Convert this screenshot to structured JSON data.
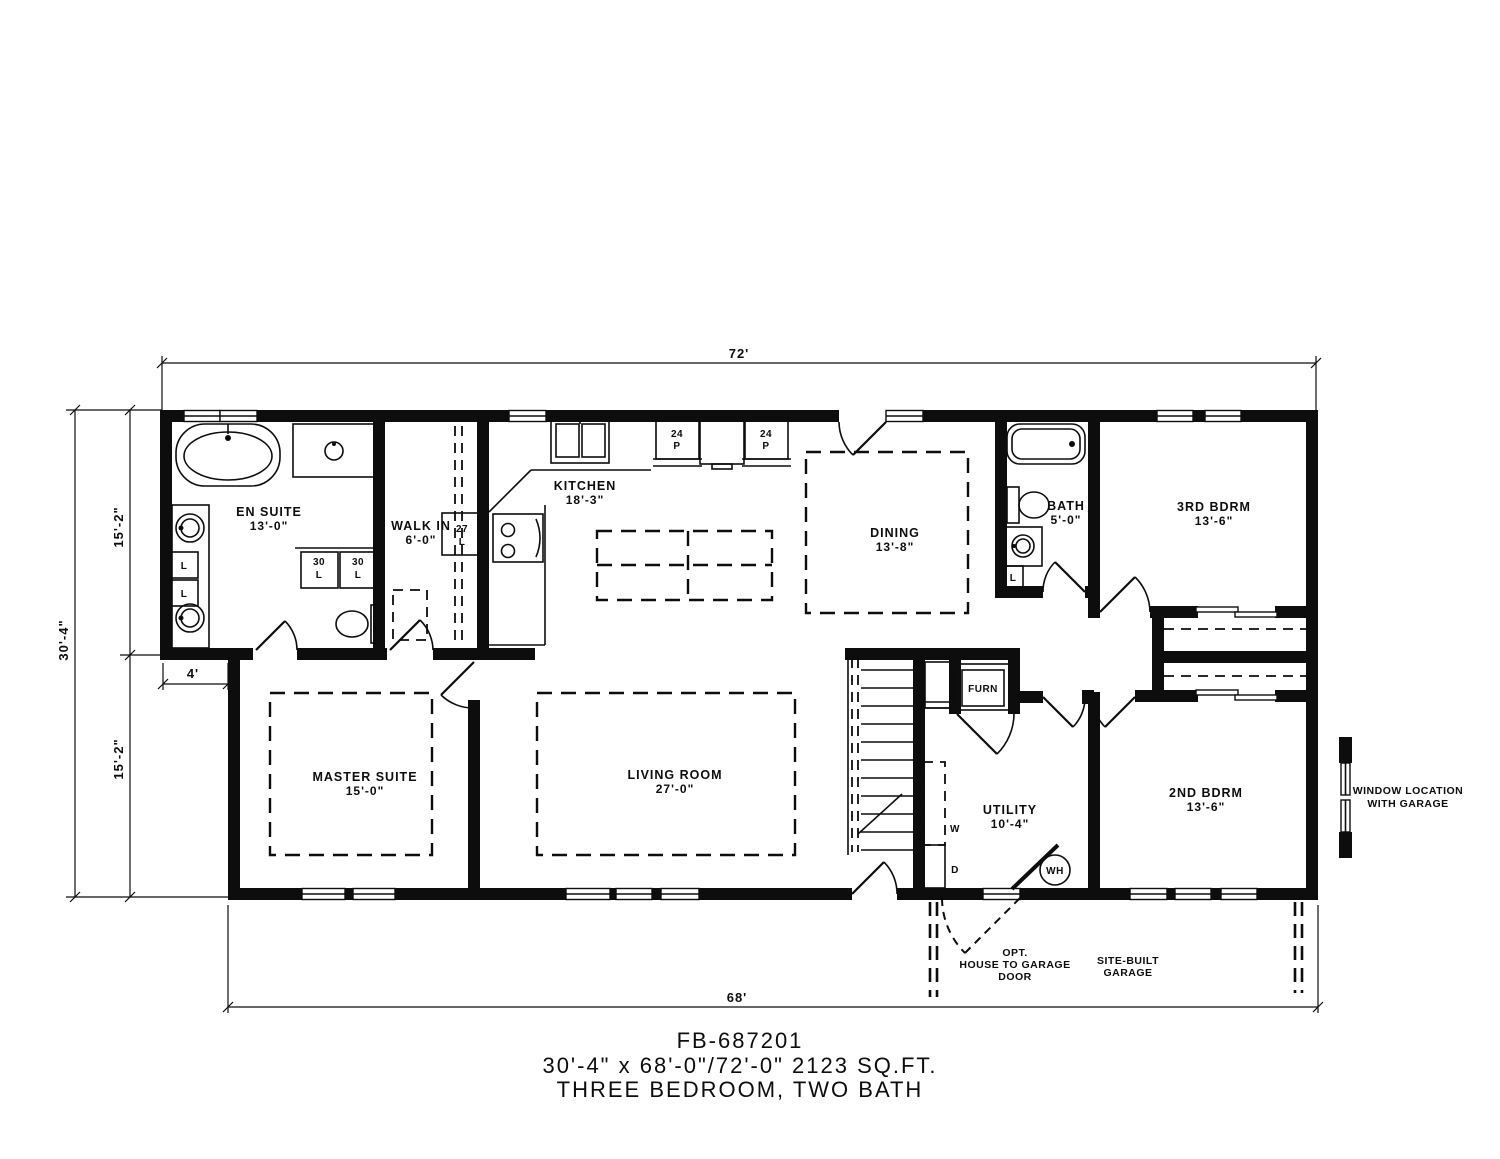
{
  "title": {
    "model": "FB-687201",
    "size_line": "30'-4\" x 68'-0\"/72'-0\" 2123 SQ.FT.",
    "beds_line": "THREE BEDROOM, TWO BATH"
  },
  "dimensions": {
    "top_width": "72'",
    "bottom_width": "68'",
    "left_total": "30'-4\"",
    "left_upper": "15'-2\"",
    "left_lower": "15'-2\"",
    "ensuite_offset": "4'"
  },
  "rooms": [
    {
      "label": "EN SUITE",
      "size": "13'-0\""
    },
    {
      "label": "WALK IN",
      "size": "6'-0\""
    },
    {
      "label": "KITCHEN",
      "size": "18'-3\""
    },
    {
      "label": "DINING",
      "size": "13'-8\""
    },
    {
      "label": "BATH",
      "size": "5'-0\""
    },
    {
      "label": "3RD BDRM",
      "size": "13'-6\""
    },
    {
      "label": "MASTER SUITE",
      "size": "15'-0\""
    },
    {
      "label": "LIVING ROOM",
      "size": "27'-0\""
    },
    {
      "label": "UTILITY",
      "size": "10'-4\""
    },
    {
      "label": "2ND BDRM",
      "size": "13'-6\""
    }
  ],
  "cabinets": {
    "pantry1": [
      "24",
      "P"
    ],
    "pantry2": [
      "24",
      "P"
    ],
    "linen27": [
      "27",
      "L"
    ],
    "linen30a": [
      "30",
      "L"
    ],
    "linen30b": [
      "30",
      "L"
    ],
    "linen_ensuite_a": "L",
    "linen_ensuite_b": "L",
    "linen_bath": "L"
  },
  "appliances": {
    "furnace": "FURN",
    "washer": "W",
    "dryer": "D",
    "water_heater": "WH"
  },
  "annotations": {
    "opt_door": [
      "OPT.",
      "HOUSE TO GARAGE",
      "DOOR"
    ],
    "garage": [
      "SITE-BUILT",
      "GARAGE"
    ],
    "window_note": [
      "WINDOW LOCATION",
      "WITH GARAGE"
    ]
  }
}
